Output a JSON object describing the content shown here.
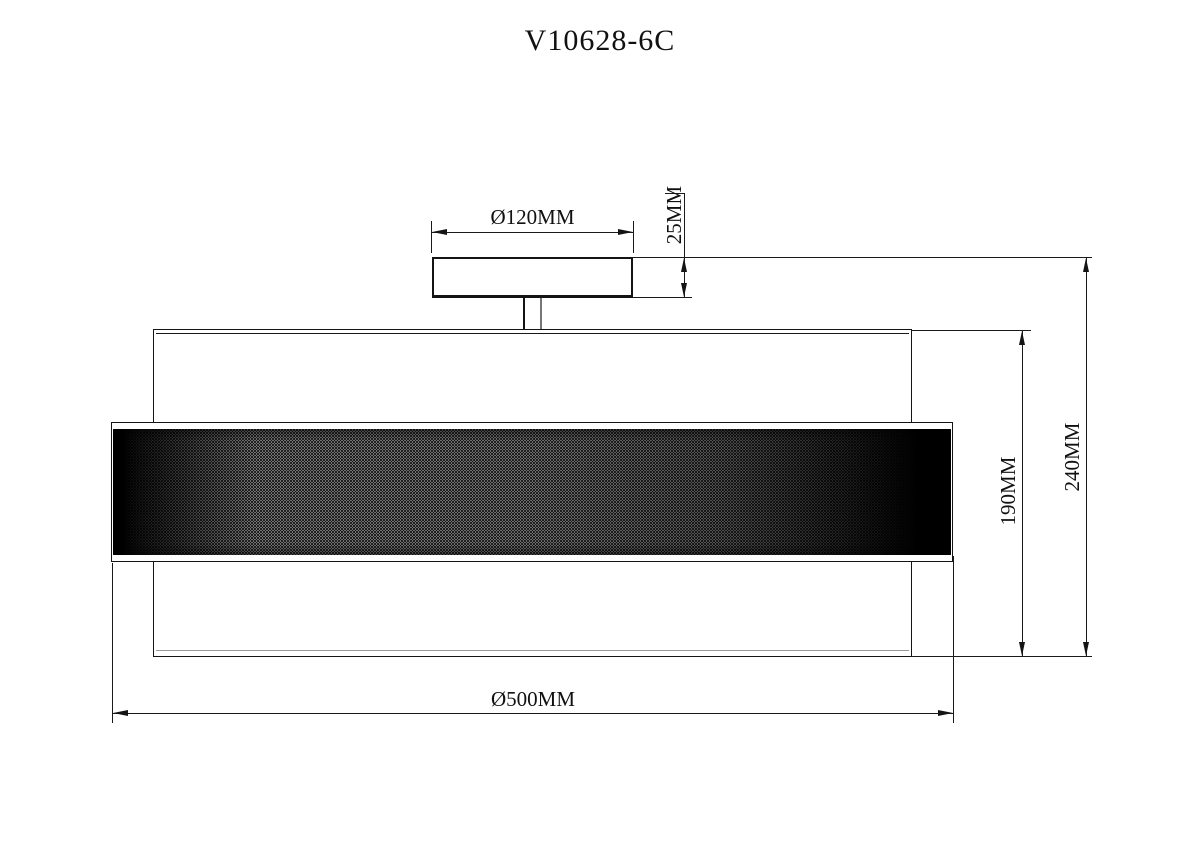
{
  "title": "V10628-6C",
  "dimensions": {
    "canopy_diameter": "Ø120MM",
    "canopy_height": "25MM",
    "shade_height": "190MM",
    "total_height": "240MM",
    "shade_diameter": "Ø500MM"
  },
  "colors": {
    "line_color": "#1a1a1a",
    "background": "#ffffff",
    "mesh_base": "#cfcfcf",
    "mesh_dark": "#000000",
    "stem_shadow_line": "#777777"
  }
}
